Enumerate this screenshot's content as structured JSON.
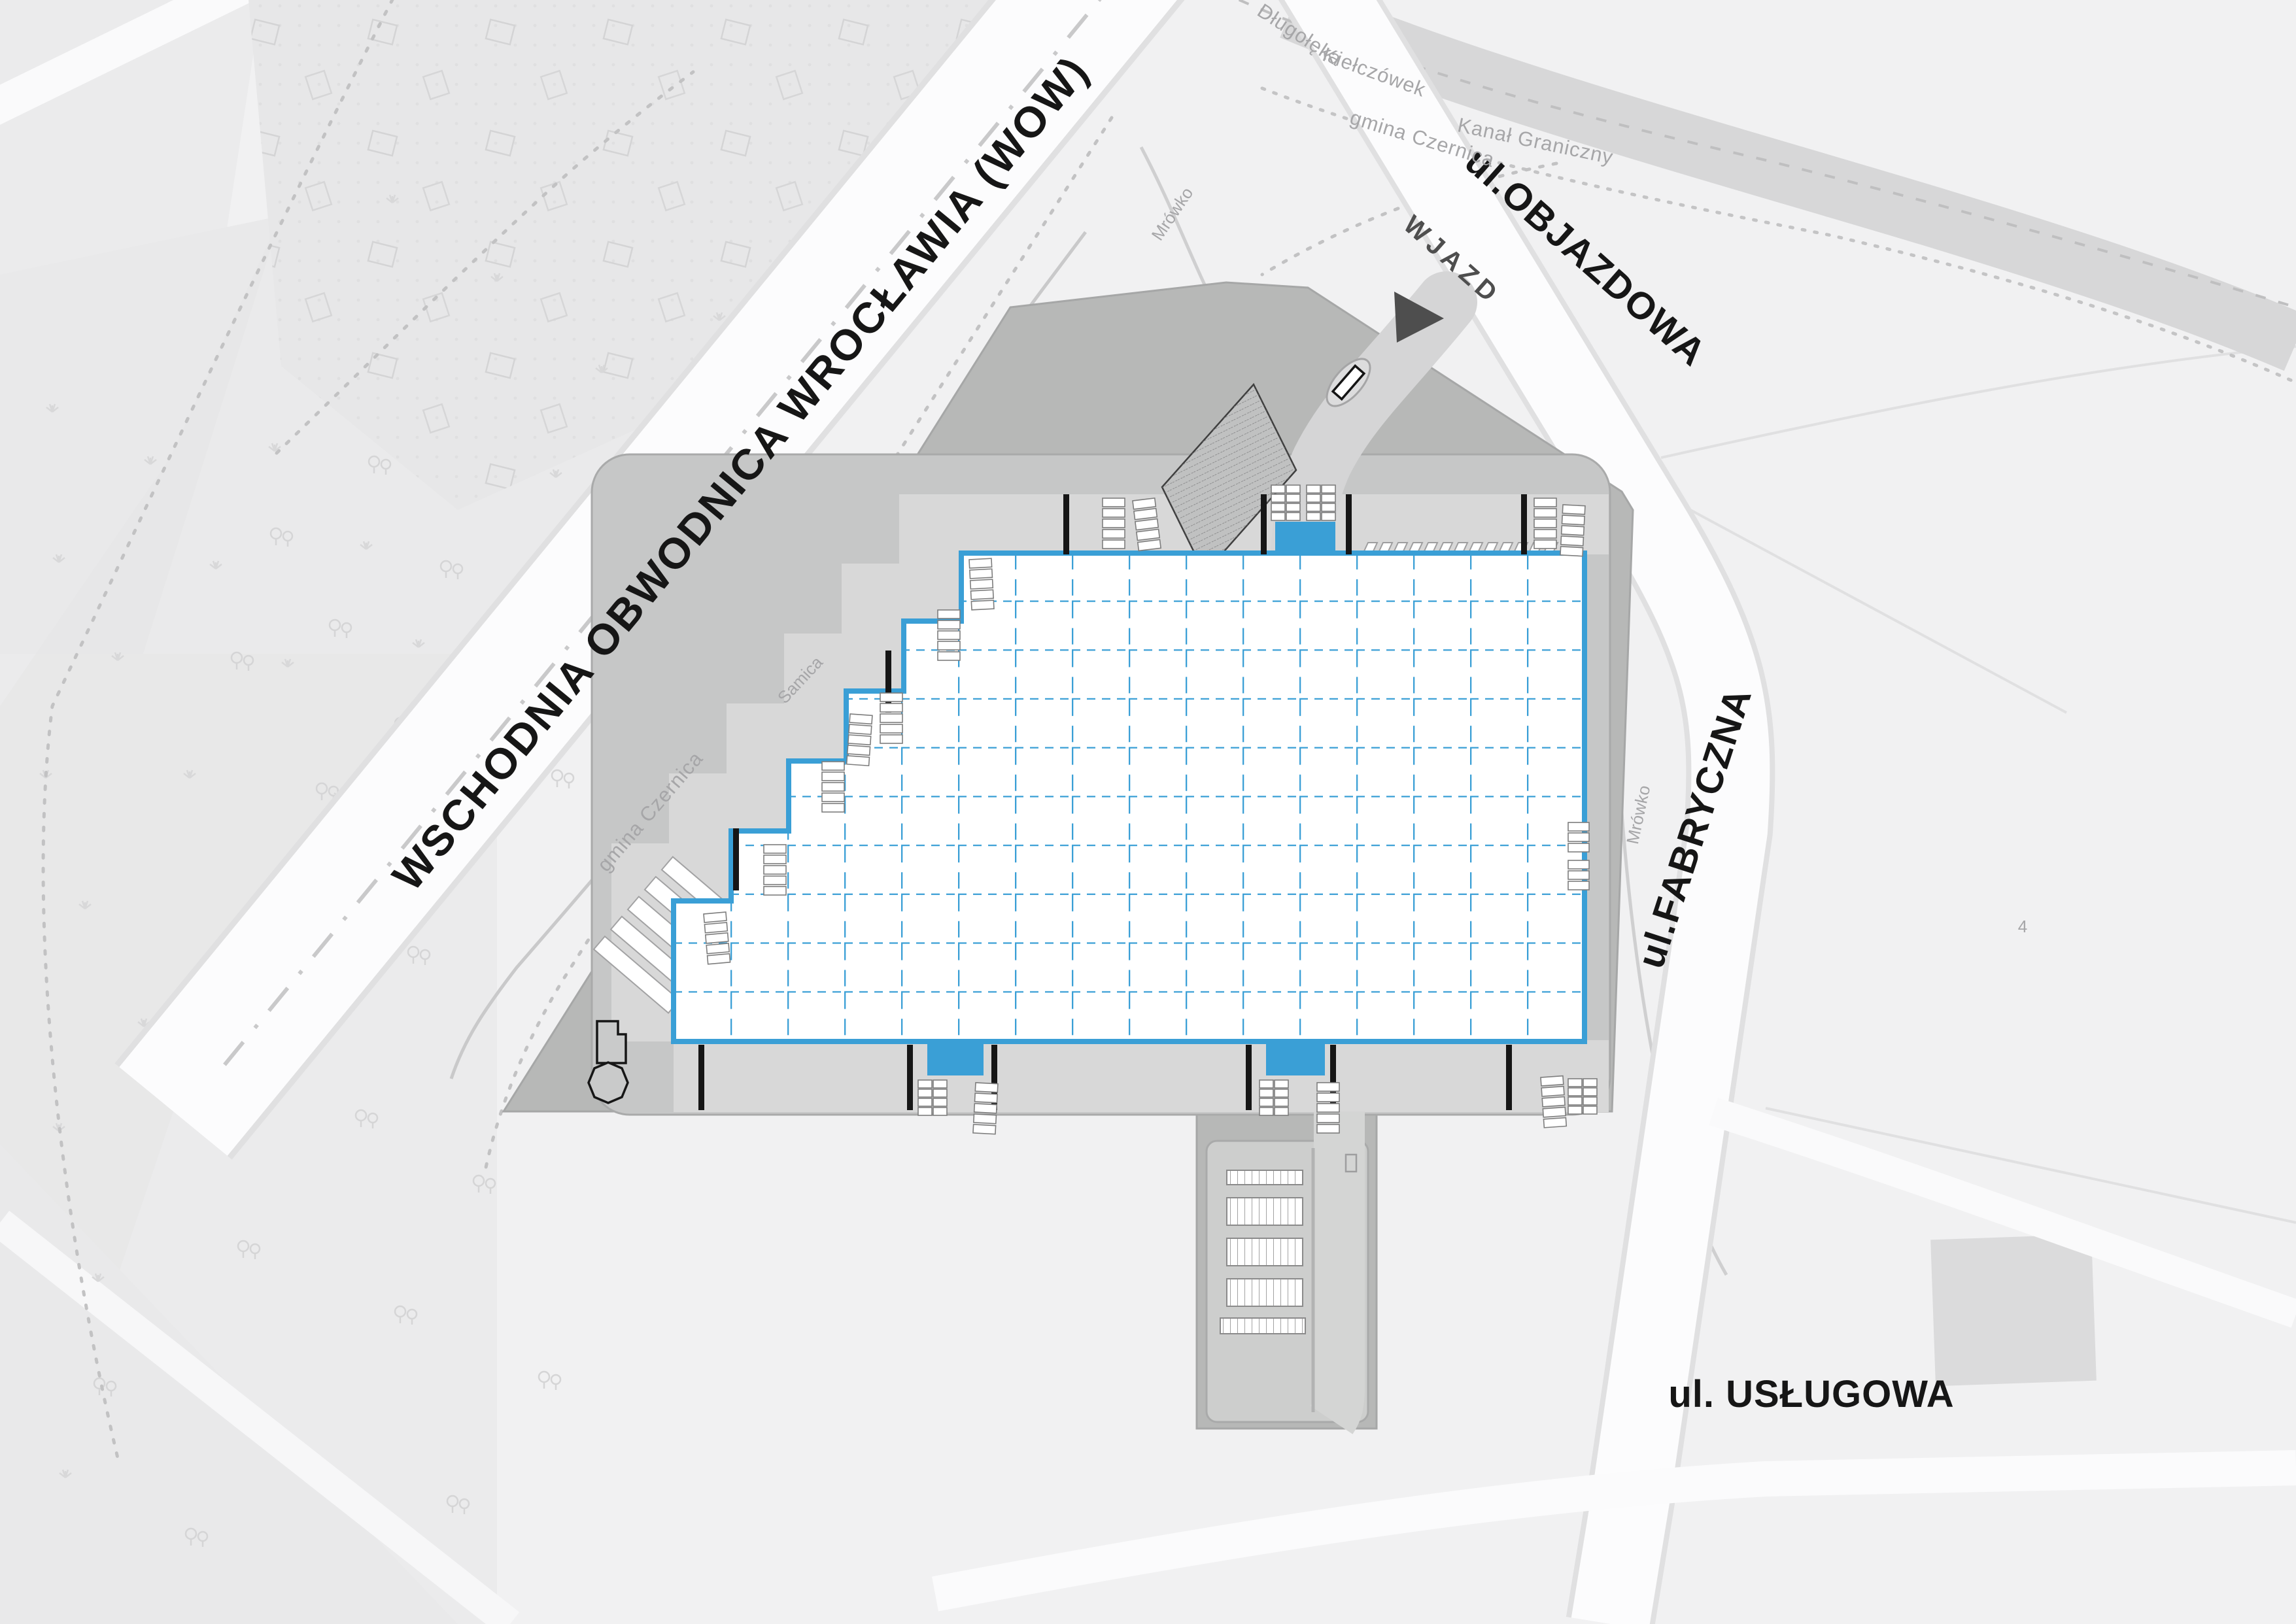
{
  "labels": {
    "ring_road": "WSCHODNIA OBWODNICA WROCŁAWIA (WOW)",
    "street_objazdowa": "ul.OBJAZDOWA",
    "street_fabryczna": "ul.FABRYCZNA",
    "street_uslugowa": "ul. USŁUGOWA",
    "entrance": "WJAZD",
    "boundary_dlugoleka": "Długołęka",
    "boundary_kielczowek": "Kiełczówek",
    "gmina_czernica_north": "gmina Czernica",
    "gmina_czernica_west": "gmina Czernica",
    "canal": "Kanał Graniczny",
    "stream_samica": "Samica",
    "stream_mrowko_north": "Mrówko",
    "stream_mrowko_east": "Mrówko",
    "parcel_number": "4"
  },
  "building": {
    "grid_columns": 16,
    "grid_rows": 10,
    "entrance_count": 3,
    "dock_bar_count_top": 4,
    "dock_bar_count_bottom": 6
  },
  "colors": {
    "accent": "#3A9FD6",
    "ink": "#161616",
    "minor": "#A6A6A8",
    "arrow": "#4E4E4E",
    "site": "#B7B8B7",
    "ring": "#C6C7C7",
    "apron": "#D8D8D8",
    "inner-road": "#D4D5D4",
    "canal": "#D7D7D8",
    "road-white": "#FCFCFD",
    "bg": "#F1F1F2"
  }
}
